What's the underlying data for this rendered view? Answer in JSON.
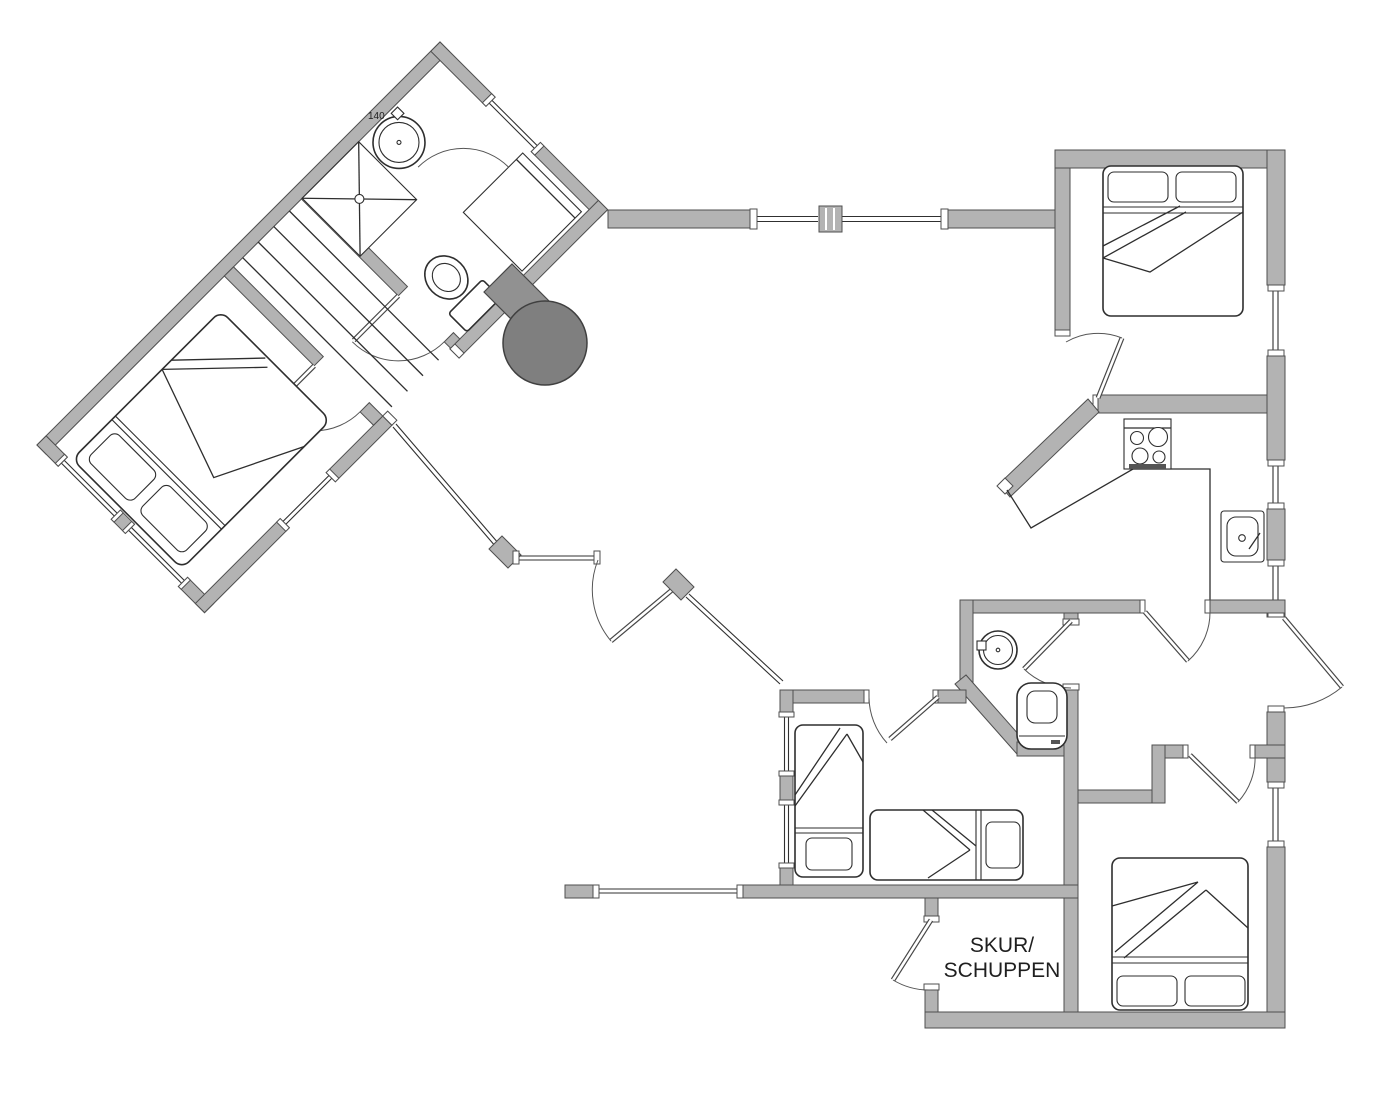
{
  "document": {
    "type": "architectural-floor-plan",
    "background": "#ffffff"
  },
  "colors": {
    "wall_fill": "#b3b3b3",
    "wall_stroke": "#4f4f4f",
    "line": "#2e2e2e",
    "door_arc": "#555555",
    "stove_fill": "#7f7f7f",
    "stove_stem_fill": "#919191",
    "text": "#1f1f1f"
  },
  "labels": {
    "shed_line1": "SKUR/",
    "shed_line2": "SCHUPPEN",
    "washer_dimension": "140"
  },
  "rooms": [
    {
      "id": "wing-bathroom"
    },
    {
      "id": "stair-hall"
    },
    {
      "id": "wing-bedroom"
    },
    {
      "id": "living-room"
    },
    {
      "id": "kitchen"
    },
    {
      "id": "bedroom-northeast"
    },
    {
      "id": "bathroom-south"
    },
    {
      "id": "bunk-bedroom"
    },
    {
      "id": "hallway"
    },
    {
      "id": "bedroom-southeast"
    },
    {
      "id": "shed"
    }
  ],
  "fixtures": [
    {
      "id": "washing-machine-wing",
      "icon": "washing-machine-icon"
    },
    {
      "id": "shower-tray",
      "icon": "shower-icon"
    },
    {
      "id": "shower-cabin",
      "icon": "cabin-icon"
    },
    {
      "id": "toilet-wing",
      "icon": "toilet-icon"
    },
    {
      "id": "stairs",
      "icon": "stairs-icon"
    },
    {
      "id": "double-bed-wing",
      "icon": "double-bed-icon"
    },
    {
      "id": "wood-stove",
      "icon": "stove-icon"
    },
    {
      "id": "cooktop",
      "icon": "cooktop-icon"
    },
    {
      "id": "kitchen-sink",
      "icon": "sink-icon"
    },
    {
      "id": "double-bed-northeast",
      "icon": "double-bed-icon"
    },
    {
      "id": "washing-machine-south",
      "icon": "washing-machine-icon"
    },
    {
      "id": "toilet-south",
      "icon": "toilet-icon"
    },
    {
      "id": "single-bed-left",
      "icon": "single-bed-icon"
    },
    {
      "id": "single-bed-right",
      "icon": "single-bed-icon"
    },
    {
      "id": "double-bed-southeast",
      "icon": "double-bed-icon"
    }
  ]
}
